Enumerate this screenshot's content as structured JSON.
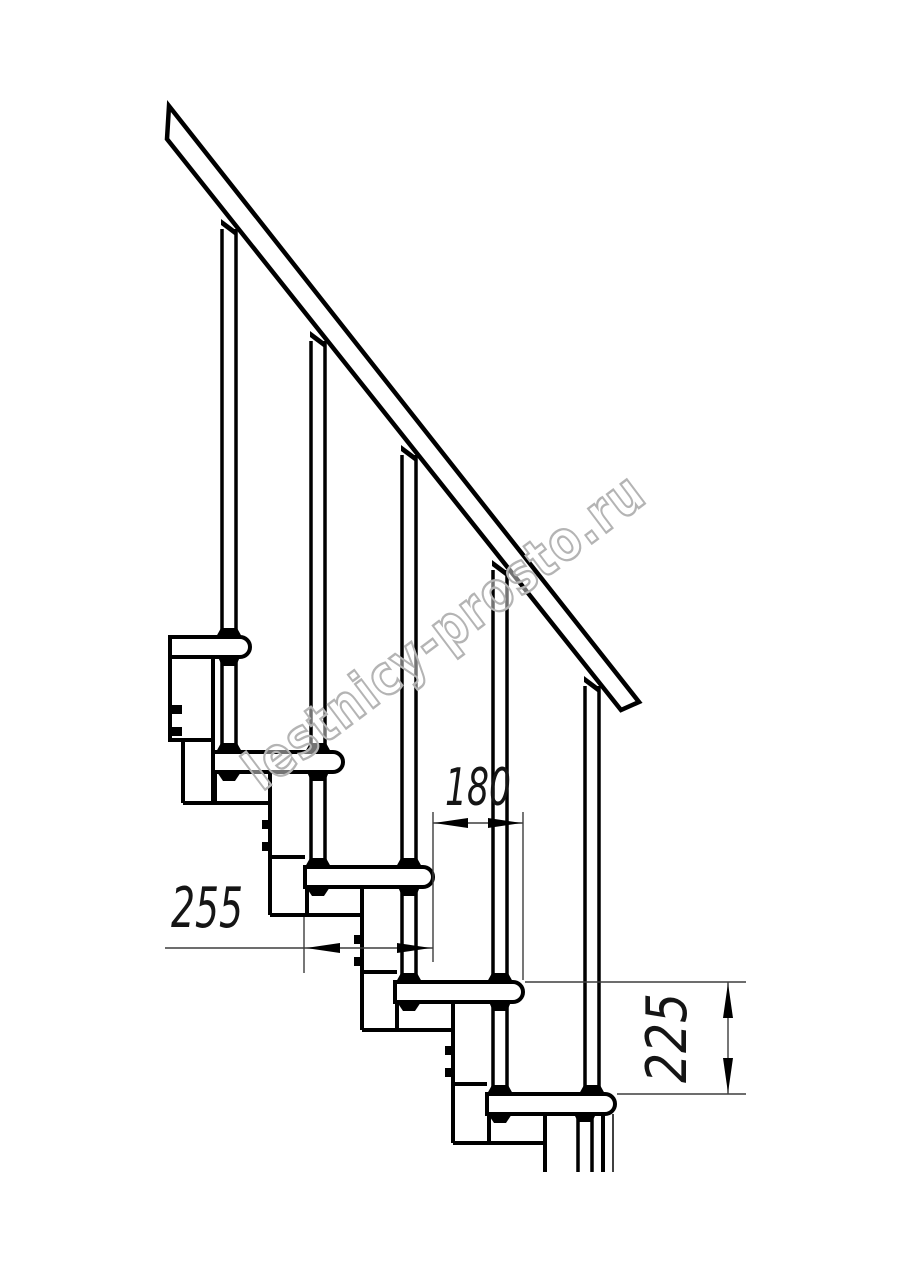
{
  "drawing": {
    "watermark_text": "lestnicy-prosto.ru",
    "dimensions": {
      "going_mm": "180",
      "tread_depth_mm": "255",
      "rise_mm": "225"
    },
    "colors": {
      "line": "#000000",
      "dim_line": "#3d3d3d",
      "watermark": "#b4b4b4",
      "background": "#ffffff"
    }
  }
}
